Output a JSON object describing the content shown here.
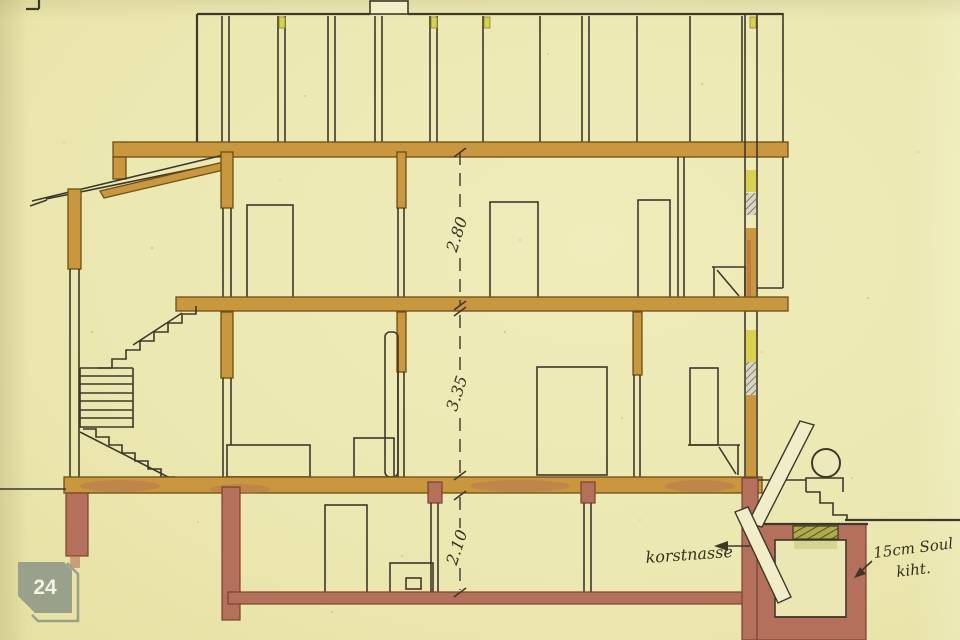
{
  "drawing": {
    "dimension_labels": {
      "upper_floor": "2.80",
      "ground_floor": "3.35",
      "basement": "2.10"
    },
    "notes": {
      "chimney": "korstnasse",
      "insulation_line1": "15cm Soul",
      "insulation_line2": "kiht."
    },
    "badge": {
      "number": "24"
    },
    "colors": {
      "paper": "#ece8b2",
      "ink": "#3e382b",
      "wood_wash": "#c9973d",
      "masonry_wash": "#b4705a",
      "accent_yellow": "#d6d24e",
      "badge_bg": "#9aa18b",
      "badge_text": "#f2f2e8"
    }
  }
}
